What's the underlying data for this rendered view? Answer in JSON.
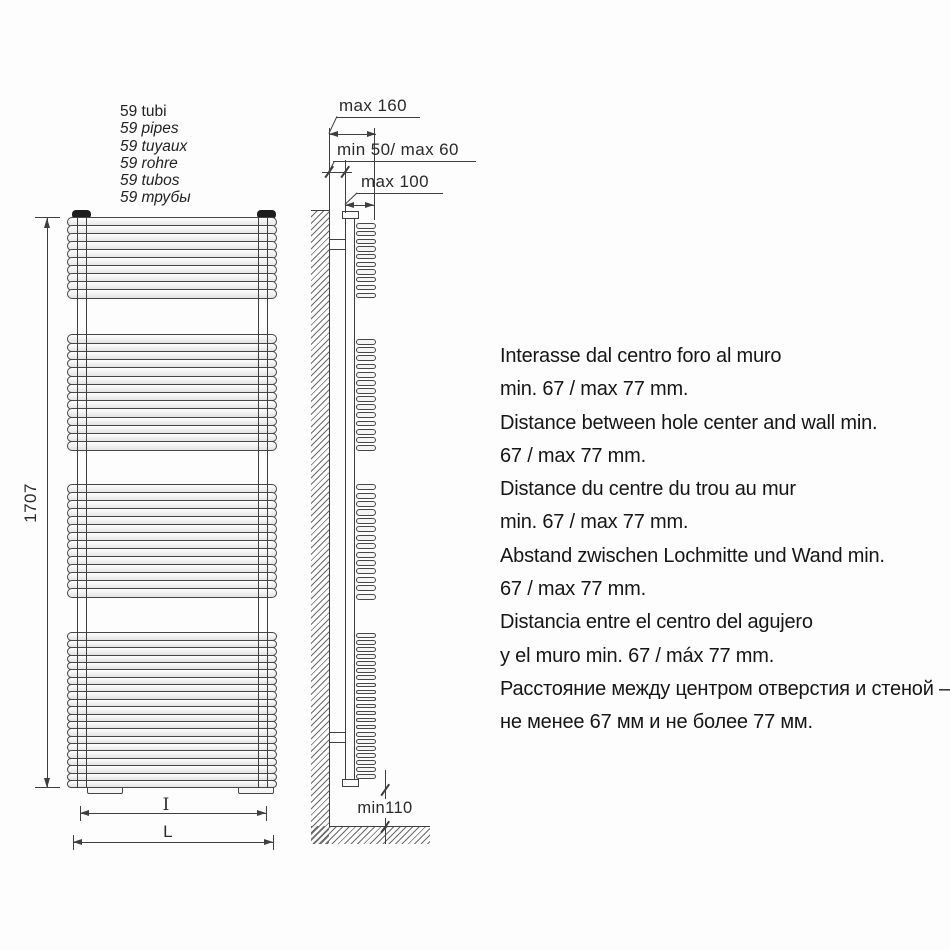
{
  "page": {
    "background": "#fdfdfd"
  },
  "colors": {
    "line": "#3f3f3f",
    "text": "#1a1a1a",
    "cap_fill": "#1d1d1d"
  },
  "tube_count_labels": [
    "59 tubi",
    "59 pipes",
    "59 tuyaux",
    "59 rohre",
    "59 tubos",
    "59 трубы"
  ],
  "front_view": {
    "tube_groups": [
      10,
      14,
      14,
      21
    ]
  },
  "dimensions": {
    "height": "1707",
    "wall_to_front": "max 160",
    "wall_to_pipe": "min 50/ max 60",
    "pipe_to_front": "max 100",
    "floor_clearance": "min110",
    "width_inner": "I",
    "width_outer": "L"
  },
  "notes": [
    {
      "lang": "it",
      "lines": [
        "Interasse dal centro foro al muro",
        "min. 67 / max 77 mm."
      ]
    },
    {
      "lang": "en",
      "lines": [
        "Distance between hole center and wall min.",
        "67 / max 77 mm."
      ]
    },
    {
      "lang": "fr",
      "lines": [
        "Distance du centre du trou au mur",
        "min. 67 / max 77 mm."
      ]
    },
    {
      "lang": "de",
      "lines": [
        "Abstand zwischen Lochmitte und Wand min.",
        "67 / max 77 mm."
      ]
    },
    {
      "lang": "es",
      "lines": [
        "Distancia entre el centro del agujero",
        "y el muro min. 67 / máx 77 mm."
      ]
    },
    {
      "lang": "ru",
      "lines": [
        "Расстояние между центром отверстия и стеной –",
        "не менее 67 мм и не более 77 мм."
      ]
    }
  ]
}
